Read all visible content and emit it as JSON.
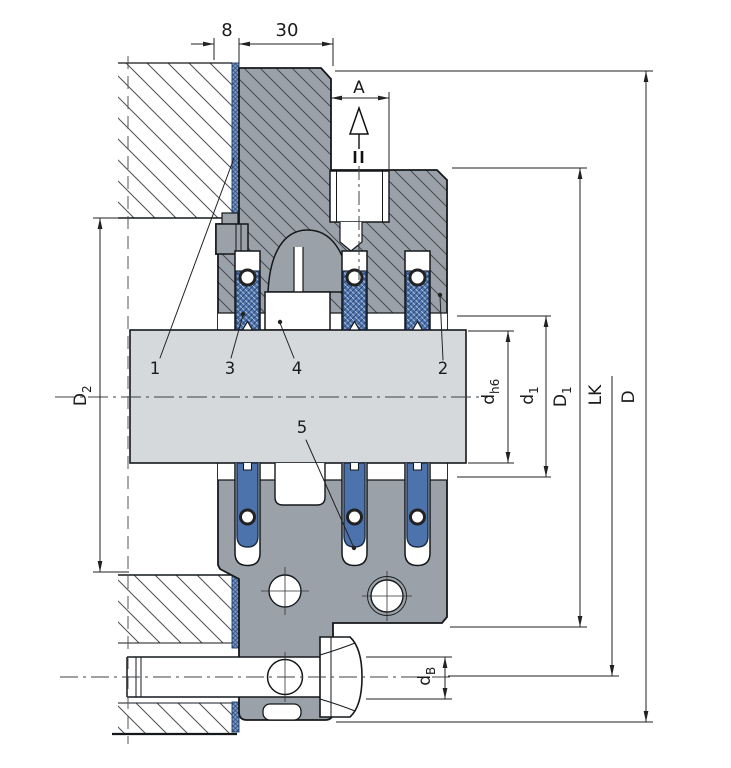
{
  "dimensions": {
    "width_small": "8",
    "width_main": "30",
    "section_arrow": "A",
    "left_bore": {
      "main": "D",
      "sub": "2"
    },
    "shaft_dia": {
      "main": "d",
      "sub": "h6"
    },
    "seal_bore": {
      "main": "d",
      "sub": "1"
    },
    "pilot_dia": {
      "main": "D",
      "sub": "1"
    },
    "bolt_circle": {
      "main": "LK",
      "sub": ""
    },
    "outer_dia": {
      "main": "D",
      "sub": ""
    },
    "bolt_dia": {
      "main": "d",
      "sub": "B"
    }
  },
  "callouts": {
    "one": "1",
    "two": "2",
    "three": "3",
    "four": "4",
    "five": "5"
  },
  "colors": {
    "body_gray": "#9aa1a8",
    "shaft_gray": "#d6d9db",
    "seal_blue": "#4d73ad",
    "gasket_blue": "#7d9dc6",
    "outline": "#15181b",
    "dim_line": "#222222",
    "white": "#ffffff"
  }
}
